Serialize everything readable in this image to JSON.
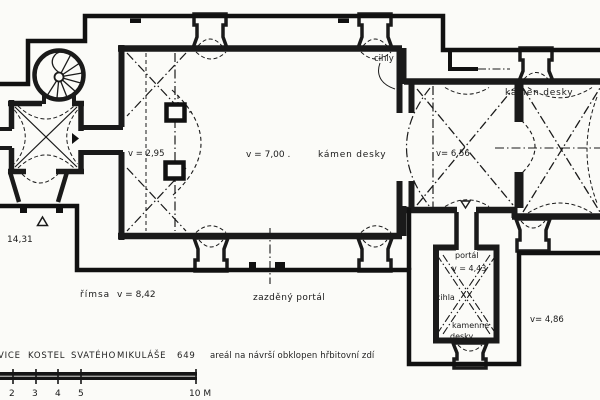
{
  "page": {
    "background": "#fbfbf8",
    "ink": "#1a1a1a"
  },
  "plan": {
    "labels": {
      "cihly": "cihly",
      "apse_material": "kámen desky",
      "nave_height": "v = 7,00 .",
      "nave_material": "kámen desky",
      "loft_height": "v = 2,95",
      "chancel_height": "v= 6,56",
      "datum_height": "14,31",
      "cornice": "římsa",
      "cornice_height": "v = 8,42",
      "walled_portal": "zazděný portál",
      "sacristy_portal": "portál",
      "sacristy_portal_height": "v = 4,43",
      "sacristy_material_brick": "cihla",
      "sacristy_material_stone_1": "kamenne",
      "sacristy_material_stone_2": "desky",
      "sacristy_height": "v= 4,86"
    },
    "caption": {
      "site_name_fragment": "VICE",
      "word_kostel": "KOSTEL",
      "word_svateho": "SVATÉHO",
      "word_mikulase": "MIKULÁŠE",
      "site_number": "649",
      "description": "areál na návrší obklopen hřbitovní zdí"
    },
    "scale_bar": {
      "tick_2": "2",
      "tick_3": "3",
      "tick_4": "4",
      "tick_5": "5",
      "end_label": "10 M"
    }
  }
}
